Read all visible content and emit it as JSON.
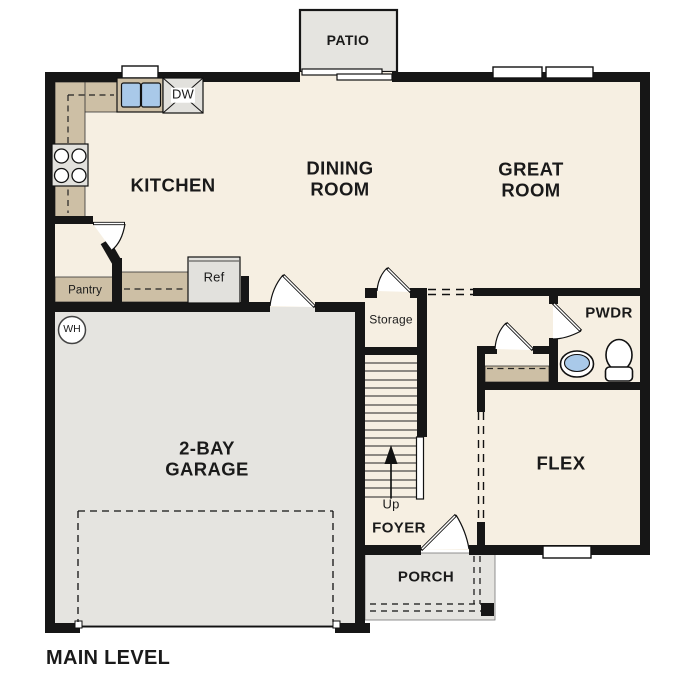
{
  "title": "MAIN LEVEL",
  "colors": {
    "wall": "#161616",
    "floor": "#f6efe2",
    "concrete": "#e5e4e0",
    "counter": "#cdbfa5",
    "water": "#a9c9e9",
    "appliance": "#e2e1dd",
    "text": "#1a1a1a"
  },
  "labels": {
    "patio": "PATIO",
    "kitchen": "KITCHEN",
    "dining_room": "DINING\nROOM",
    "great_room": "GREAT\nROOM",
    "garage": "2-BAY\nGARAGE",
    "flex": "FLEX",
    "powder": "PWDR",
    "foyer": "FOYER",
    "porch": "PORCH",
    "storage": "Storage",
    "up": "Up",
    "pantry": "Pantry",
    "refrigerator": "Ref",
    "dishwasher": "DW",
    "water_heater": "WH",
    "main_level": "MAIN LEVEL"
  }
}
